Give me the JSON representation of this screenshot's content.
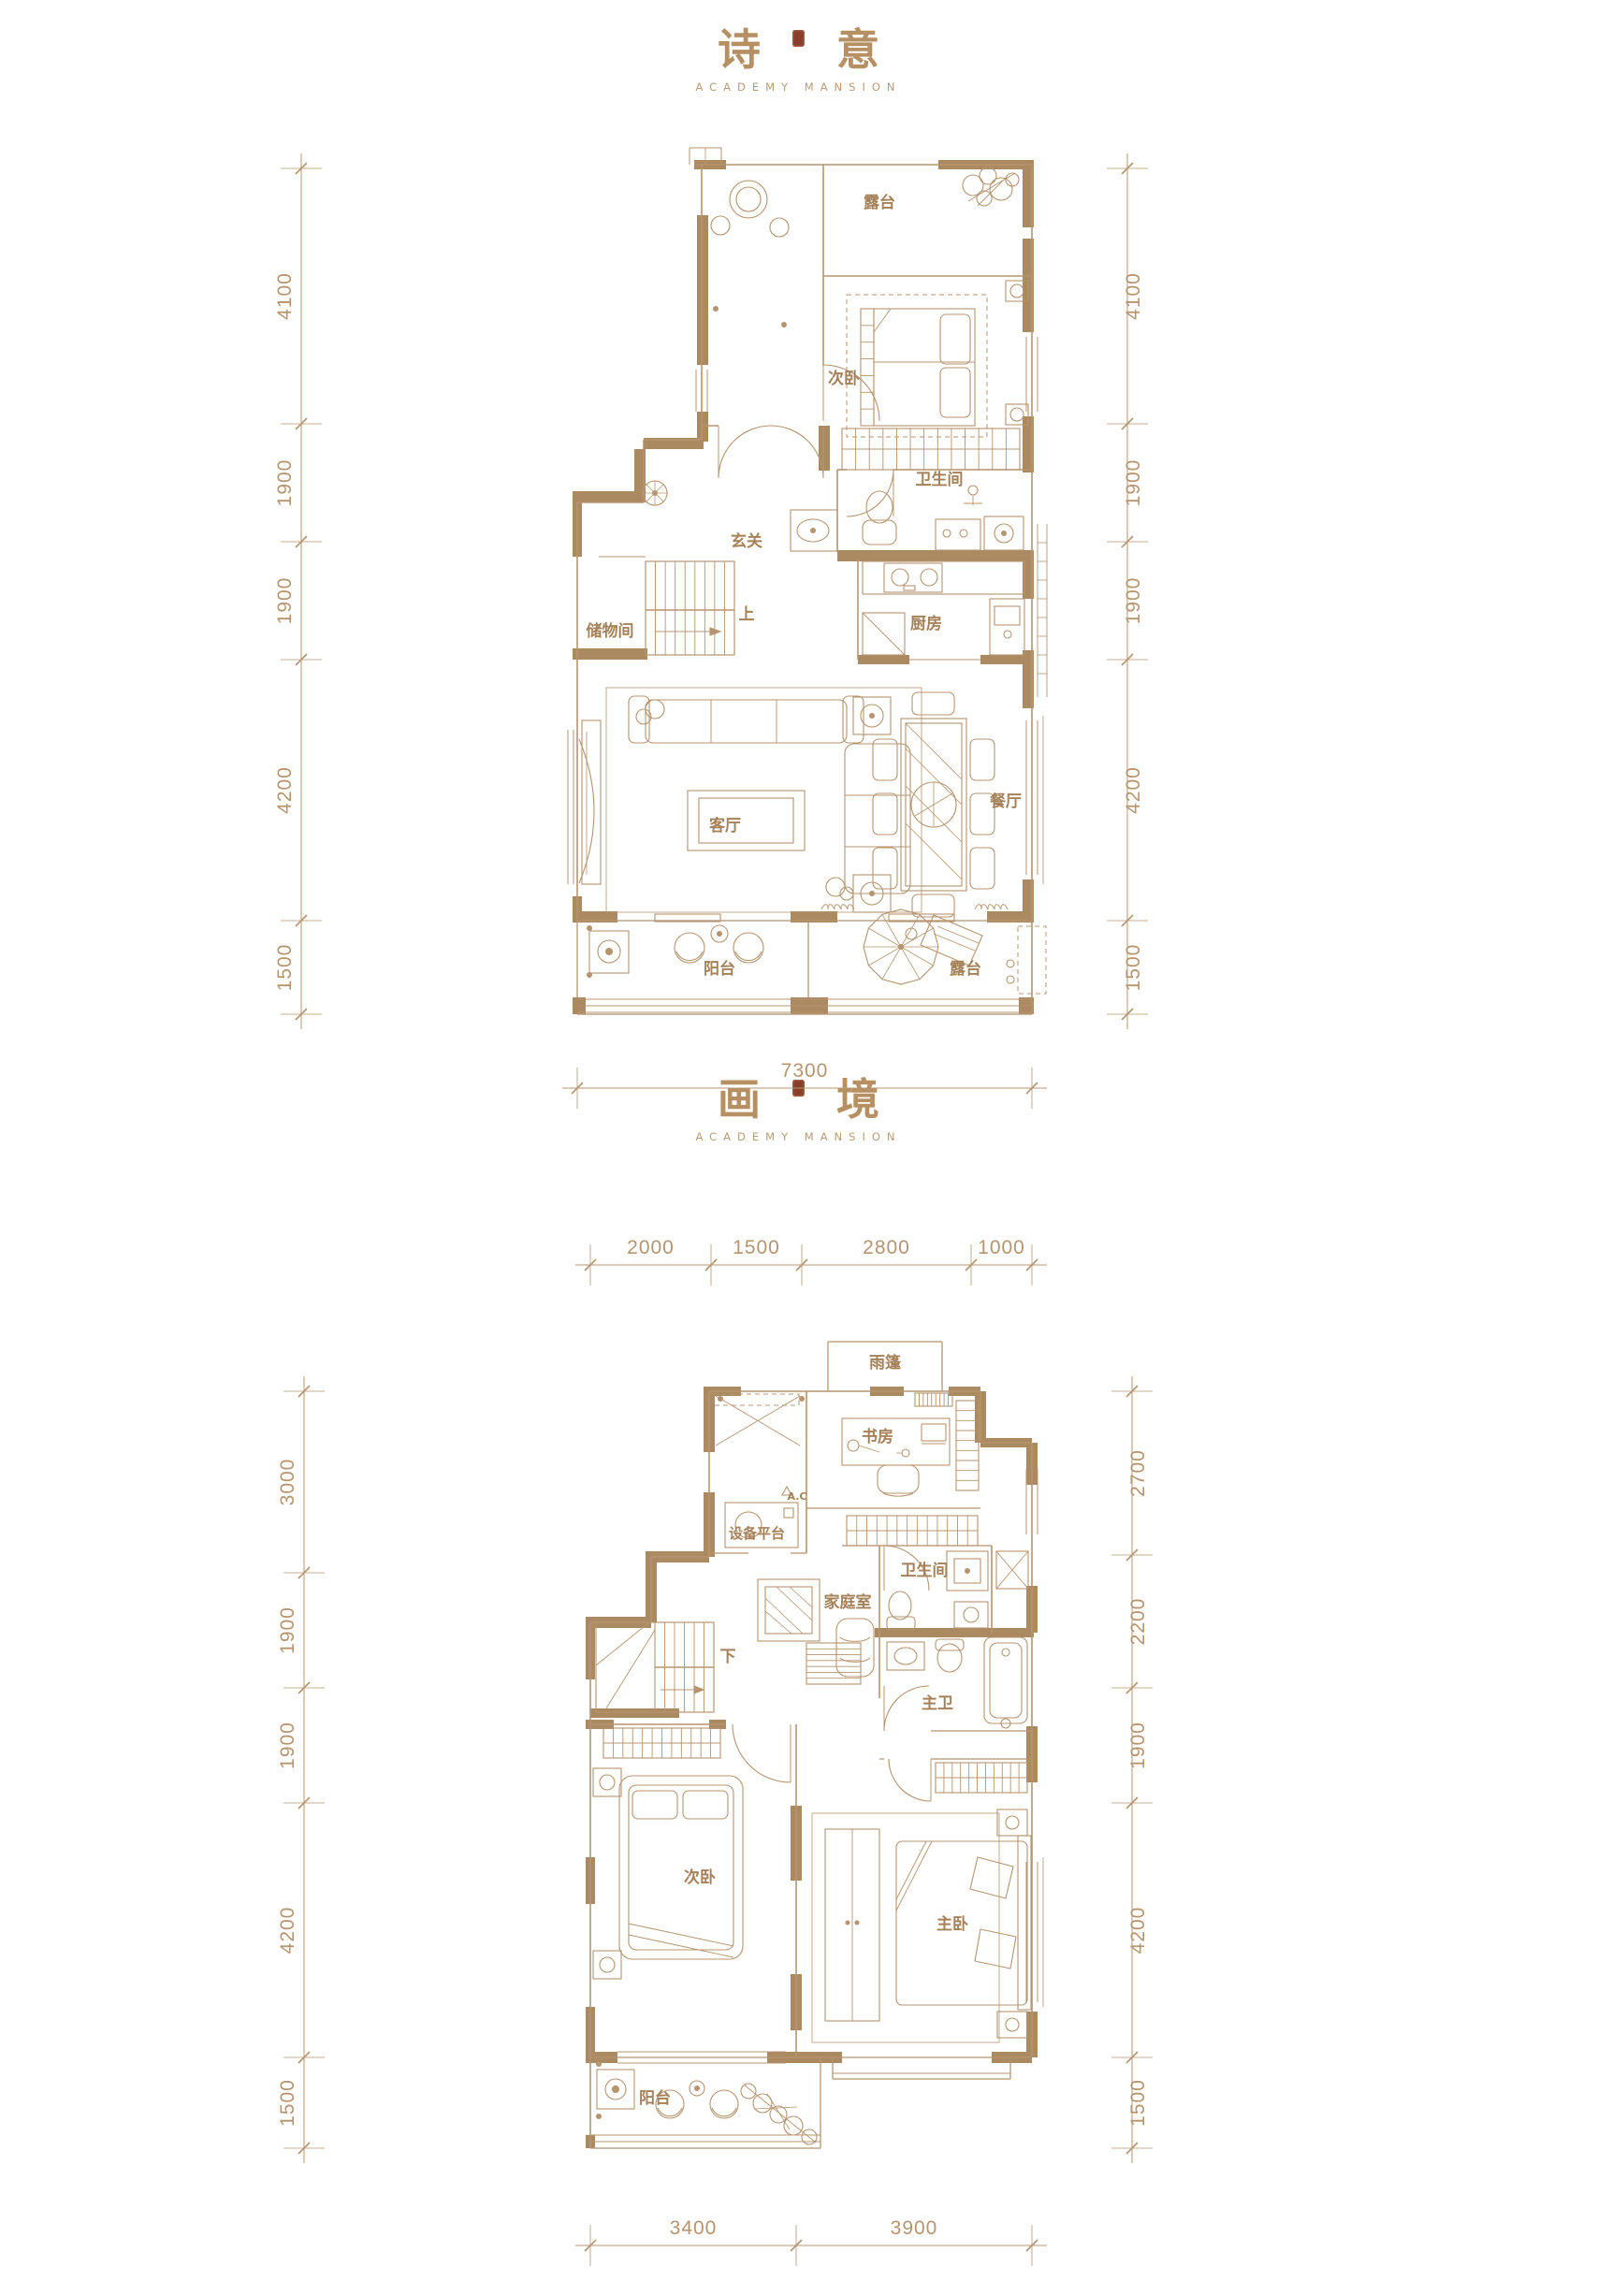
{
  "page": {
    "background": "#ffffff",
    "line_color": "#b5946f",
    "wall_fill": "#ac8a61",
    "label_color": "#a5815a",
    "title_color": "#b68f63",
    "seal_color": "#8a3f2b"
  },
  "plans": [
    {
      "id": "plan1",
      "title_chars": [
        "诗",
        "意"
      ],
      "subtitle": "ACADEMY MANSION",
      "rooms": {
        "terrace_top": "露台",
        "bedroom2": "次卧",
        "hallway": "玄关",
        "bathroom": "卫生间",
        "storage": "储物间",
        "stairs_up": "上",
        "kitchen": "厨房",
        "living": "客厅",
        "dining": "餐厅",
        "balcony": "阳台",
        "terrace_bottom": "露台"
      },
      "dims": {
        "left": [
          "4100",
          "1900",
          "1900",
          "4200",
          "1500"
        ],
        "right": [
          "4100",
          "1900",
          "1900",
          "4200",
          "1500"
        ],
        "bottom": [
          "7300"
        ]
      }
    },
    {
      "id": "plan2",
      "title_chars": [
        "画",
        "境"
      ],
      "subtitle": "ACADEMY MANSION",
      "rooms": {
        "canopy": "雨篷",
        "study": "书房",
        "equipment": "设备平台",
        "ac": "A.C",
        "bathroom": "卫生间",
        "family": "家庭室",
        "stairs_down": "下",
        "master_bath": "主卫",
        "bedroom2": "次卧",
        "master": "主卧",
        "balcony": "阳台"
      },
      "dims": {
        "top": [
          "2000",
          "1500",
          "2800",
          "1000"
        ],
        "left": [
          "3000",
          "1900",
          "1900",
          "4200",
          "1500"
        ],
        "right": [
          "2700",
          "2200",
          "1900",
          "4200",
          "1500"
        ],
        "bottom": [
          "3400",
          "3900"
        ]
      }
    }
  ]
}
